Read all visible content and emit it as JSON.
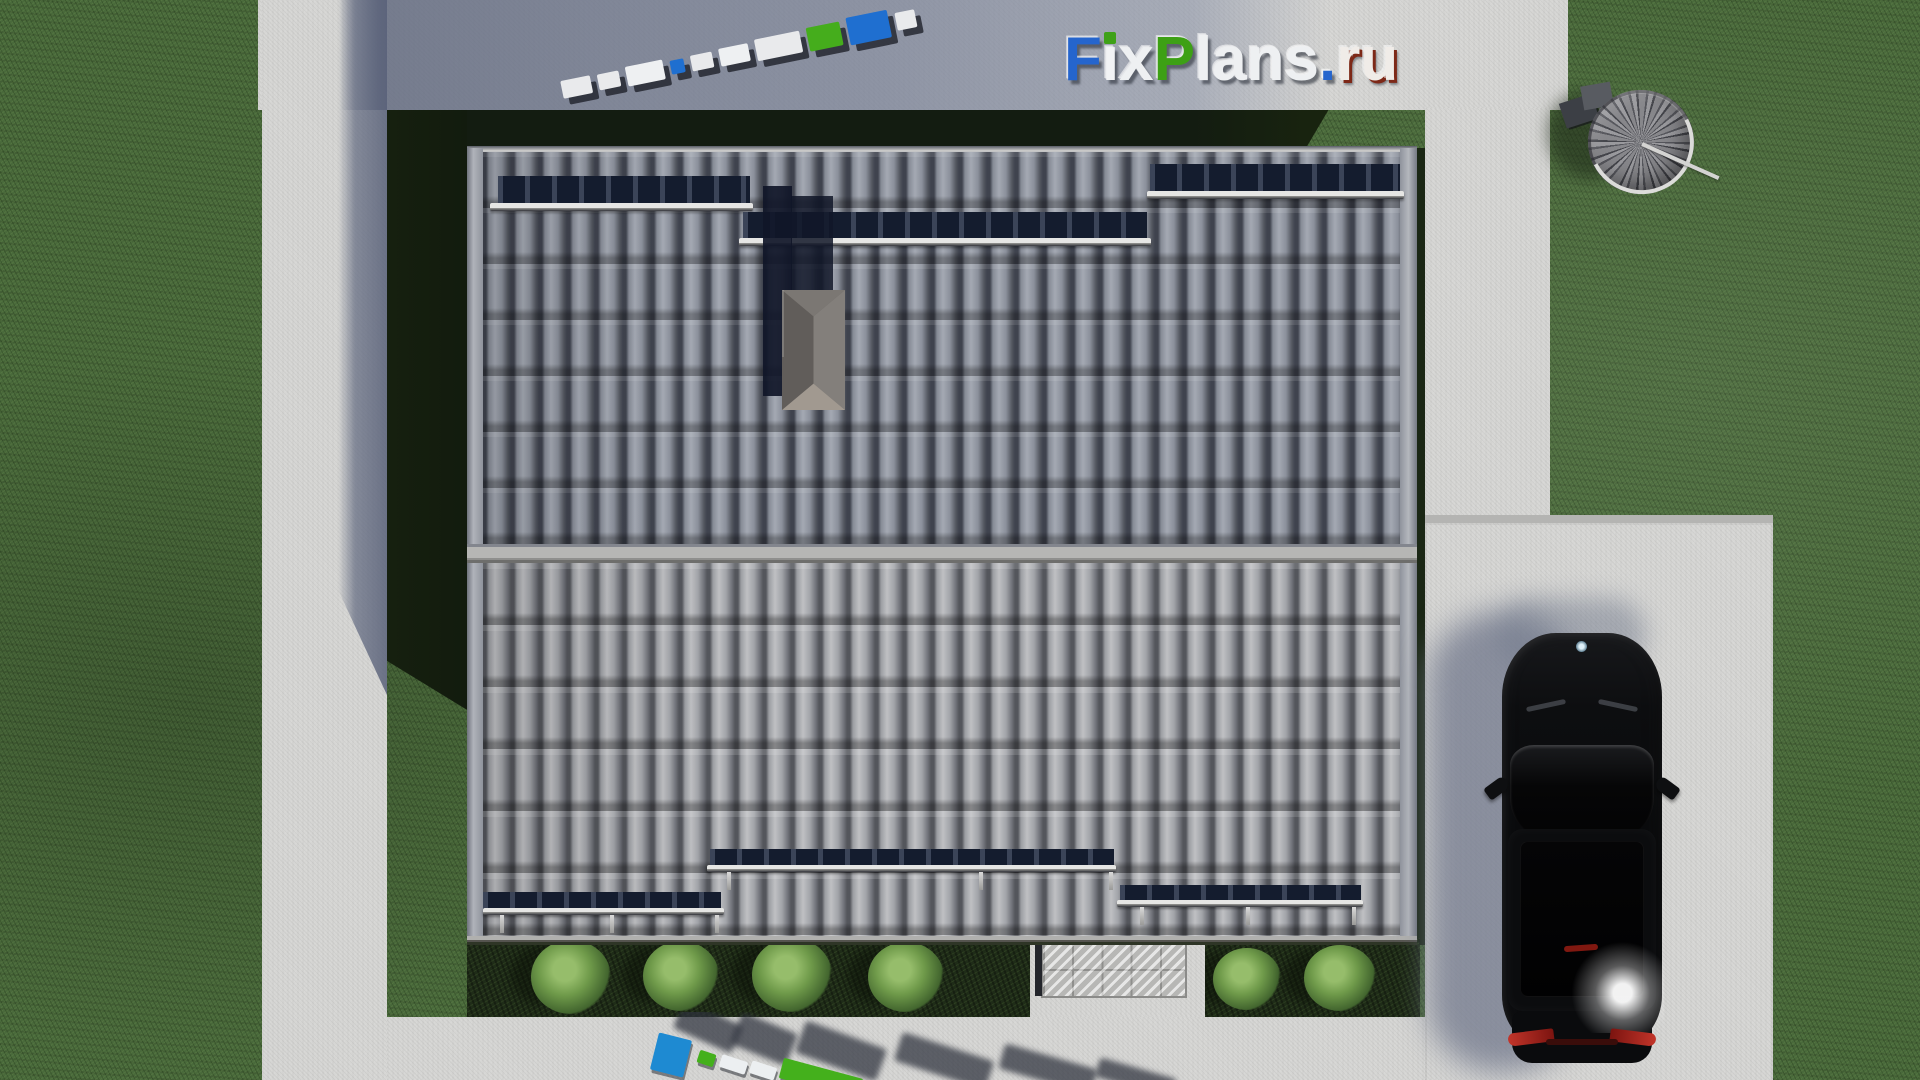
{
  "scene_description": "Aerial top-down 3D architectural render: house with gray tiled gable roof, chimney, snow guards, concrete paths around a lawn, black sedan on a parking pad, spiral staircase on grass, round bushes, FixPlans.ru watermarks",
  "watermark": {
    "text": "FixPlans.ru",
    "letters": [
      {
        "char": "F",
        "color": "#2565cd"
      },
      {
        "char": "i",
        "color": "#f2f3f5",
        "dot": "#3ea117"
      },
      {
        "char": "x",
        "color": "#eef0f2"
      },
      {
        "char": "P",
        "color": "#3da015"
      },
      {
        "char": "l",
        "color": "#eef0f2"
      },
      {
        "char": "a",
        "color": "#eef0f2"
      },
      {
        "char": "n",
        "color": "#eef0f2"
      },
      {
        "char": "s",
        "color": "#eef0f2"
      },
      {
        "char": ".",
        "color": "#2565cd"
      },
      {
        "char": "r",
        "color": "#f0ece8",
        "edge": "#7d2817"
      },
      {
        "char": "u",
        "color": "#f0ece8",
        "edge": "#7d2817"
      }
    ]
  },
  "logo3d_top": {
    "label": "FixPlans.ru 3D standing letters seen from above",
    "blocks": [
      {
        "w": 30,
        "h": 18,
        "color": "#e9eaec"
      },
      {
        "w": 22,
        "h": 16,
        "color": "#e9eaec"
      },
      {
        "w": 38,
        "h": 20,
        "color": "#eef0f2"
      },
      {
        "w": 14,
        "h": 14,
        "color": "#1f6fd0"
      },
      {
        "w": 22,
        "h": 16,
        "color": "#e9eaec"
      },
      {
        "w": 30,
        "h": 18,
        "color": "#eef0f2"
      },
      {
        "w": 46,
        "h": 22,
        "color": "#e9eaec"
      },
      {
        "w": 34,
        "h": 24,
        "color": "#45ad1c"
      },
      {
        "w": 42,
        "h": 28,
        "color": "#1f6fd0"
      },
      {
        "w": 20,
        "h": 18,
        "color": "#e9eaec"
      }
    ]
  },
  "logo3d_bottom": {
    "label": "FixPlans.ru 3D standing letters seen from above, casting long shadows",
    "blocks": [
      {
        "x": 6,
        "y": 24,
        "w": 34,
        "h": 38,
        "rot": 14,
        "color": "#1e8ad2"
      },
      {
        "x": 50,
        "y": 40,
        "w": 17,
        "h": 13,
        "rot": 18,
        "color": "#44b01c"
      },
      {
        "x": 72,
        "y": 46,
        "w": 27,
        "h": 13,
        "rot": 18,
        "color": "#eceff1"
      },
      {
        "x": 102,
        "y": 52,
        "w": 26,
        "h": 13,
        "rot": 18,
        "color": "#eceff1"
      },
      {
        "x": 132,
        "y": 56,
        "w": 82,
        "h": 21,
        "rot": 15,
        "color": "#44b01c"
      },
      {
        "x": 220,
        "y": 74,
        "w": 36,
        "h": 15,
        "rot": 18,
        "color": "#eceff1"
      },
      {
        "x": 260,
        "y": 80,
        "w": 30,
        "h": 14,
        "rot": 18,
        "color": "#eceff1"
      }
    ],
    "shadows": [
      {
        "x": 28,
        "y": 0,
        "w": 64,
        "h": 30,
        "rot": 24
      },
      {
        "x": 86,
        "y": 10,
        "w": 60,
        "h": 34,
        "rot": 22
      },
      {
        "x": 150,
        "y": 22,
        "w": 86,
        "h": 34,
        "rot": 20
      },
      {
        "x": 248,
        "y": 34,
        "w": 96,
        "h": 30,
        "rot": 18
      },
      {
        "x": 352,
        "y": 44,
        "w": 96,
        "h": 26,
        "rot": 16
      },
      {
        "x": 448,
        "y": 56,
        "w": 80,
        "h": 20,
        "rot": 16
      }
    ]
  },
  "garden": {
    "bushes": [
      {
        "cx": 571,
        "cy": 977,
        "r": 40
      },
      {
        "cx": 681,
        "cy": 976,
        "r": 38
      },
      {
        "cx": 792,
        "cy": 975,
        "r": 40
      },
      {
        "cx": 906,
        "cy": 977,
        "r": 38
      },
      {
        "cx": 1247,
        "cy": 979,
        "r": 34
      },
      {
        "cx": 1340,
        "cy": 978,
        "r": 36
      }
    ]
  },
  "roof": {
    "snow_guards": [
      {
        "name": "upper-left",
        "band": [
          498,
          176,
          252,
          28
        ],
        "bar": [
          490,
          203,
          263,
          8
        ]
      },
      {
        "name": "upper-middle",
        "band": [
          743,
          212,
          404,
          27
        ],
        "bar": [
          739,
          238,
          412,
          8
        ]
      },
      {
        "name": "upper-right",
        "band": [
          1150,
          164,
          250,
          28
        ],
        "bar": [
          1147,
          191,
          257,
          8
        ]
      },
      {
        "name": "lower-left",
        "band": [
          483,
          892,
          238,
          17
        ],
        "bar": [
          483,
          908,
          241,
          7
        ]
      },
      {
        "name": "lower-middle",
        "band": [
          710,
          849,
          404,
          17
        ],
        "bar": [
          707,
          865,
          409,
          7
        ]
      },
      {
        "name": "lower-right",
        "band": [
          1120,
          885,
          241,
          16
        ],
        "bar": [
          1117,
          900,
          246,
          7
        ]
      }
    ],
    "ticks": [
      [
        500,
        915
      ],
      [
        610,
        915
      ],
      [
        715,
        915
      ],
      [
        727,
        872
      ],
      [
        979,
        872
      ],
      [
        1109,
        872
      ],
      [
        1140,
        907
      ],
      [
        1246,
        907
      ],
      [
        1352,
        907
      ]
    ]
  },
  "palette": {
    "brand_blue": "#2565cd",
    "brand_green": "#3ea117",
    "grass": "#49693b",
    "grass_shadow": "#18230f",
    "concrete": "#d6d6d4",
    "concrete_shadow": "#7d8498",
    "roof_upper": "#878b94",
    "roof_lower": "#9fa0a3",
    "ridge": "#b6b6b4",
    "car_body": "#0a0b0d",
    "taillight_red": "#b22a20"
  }
}
